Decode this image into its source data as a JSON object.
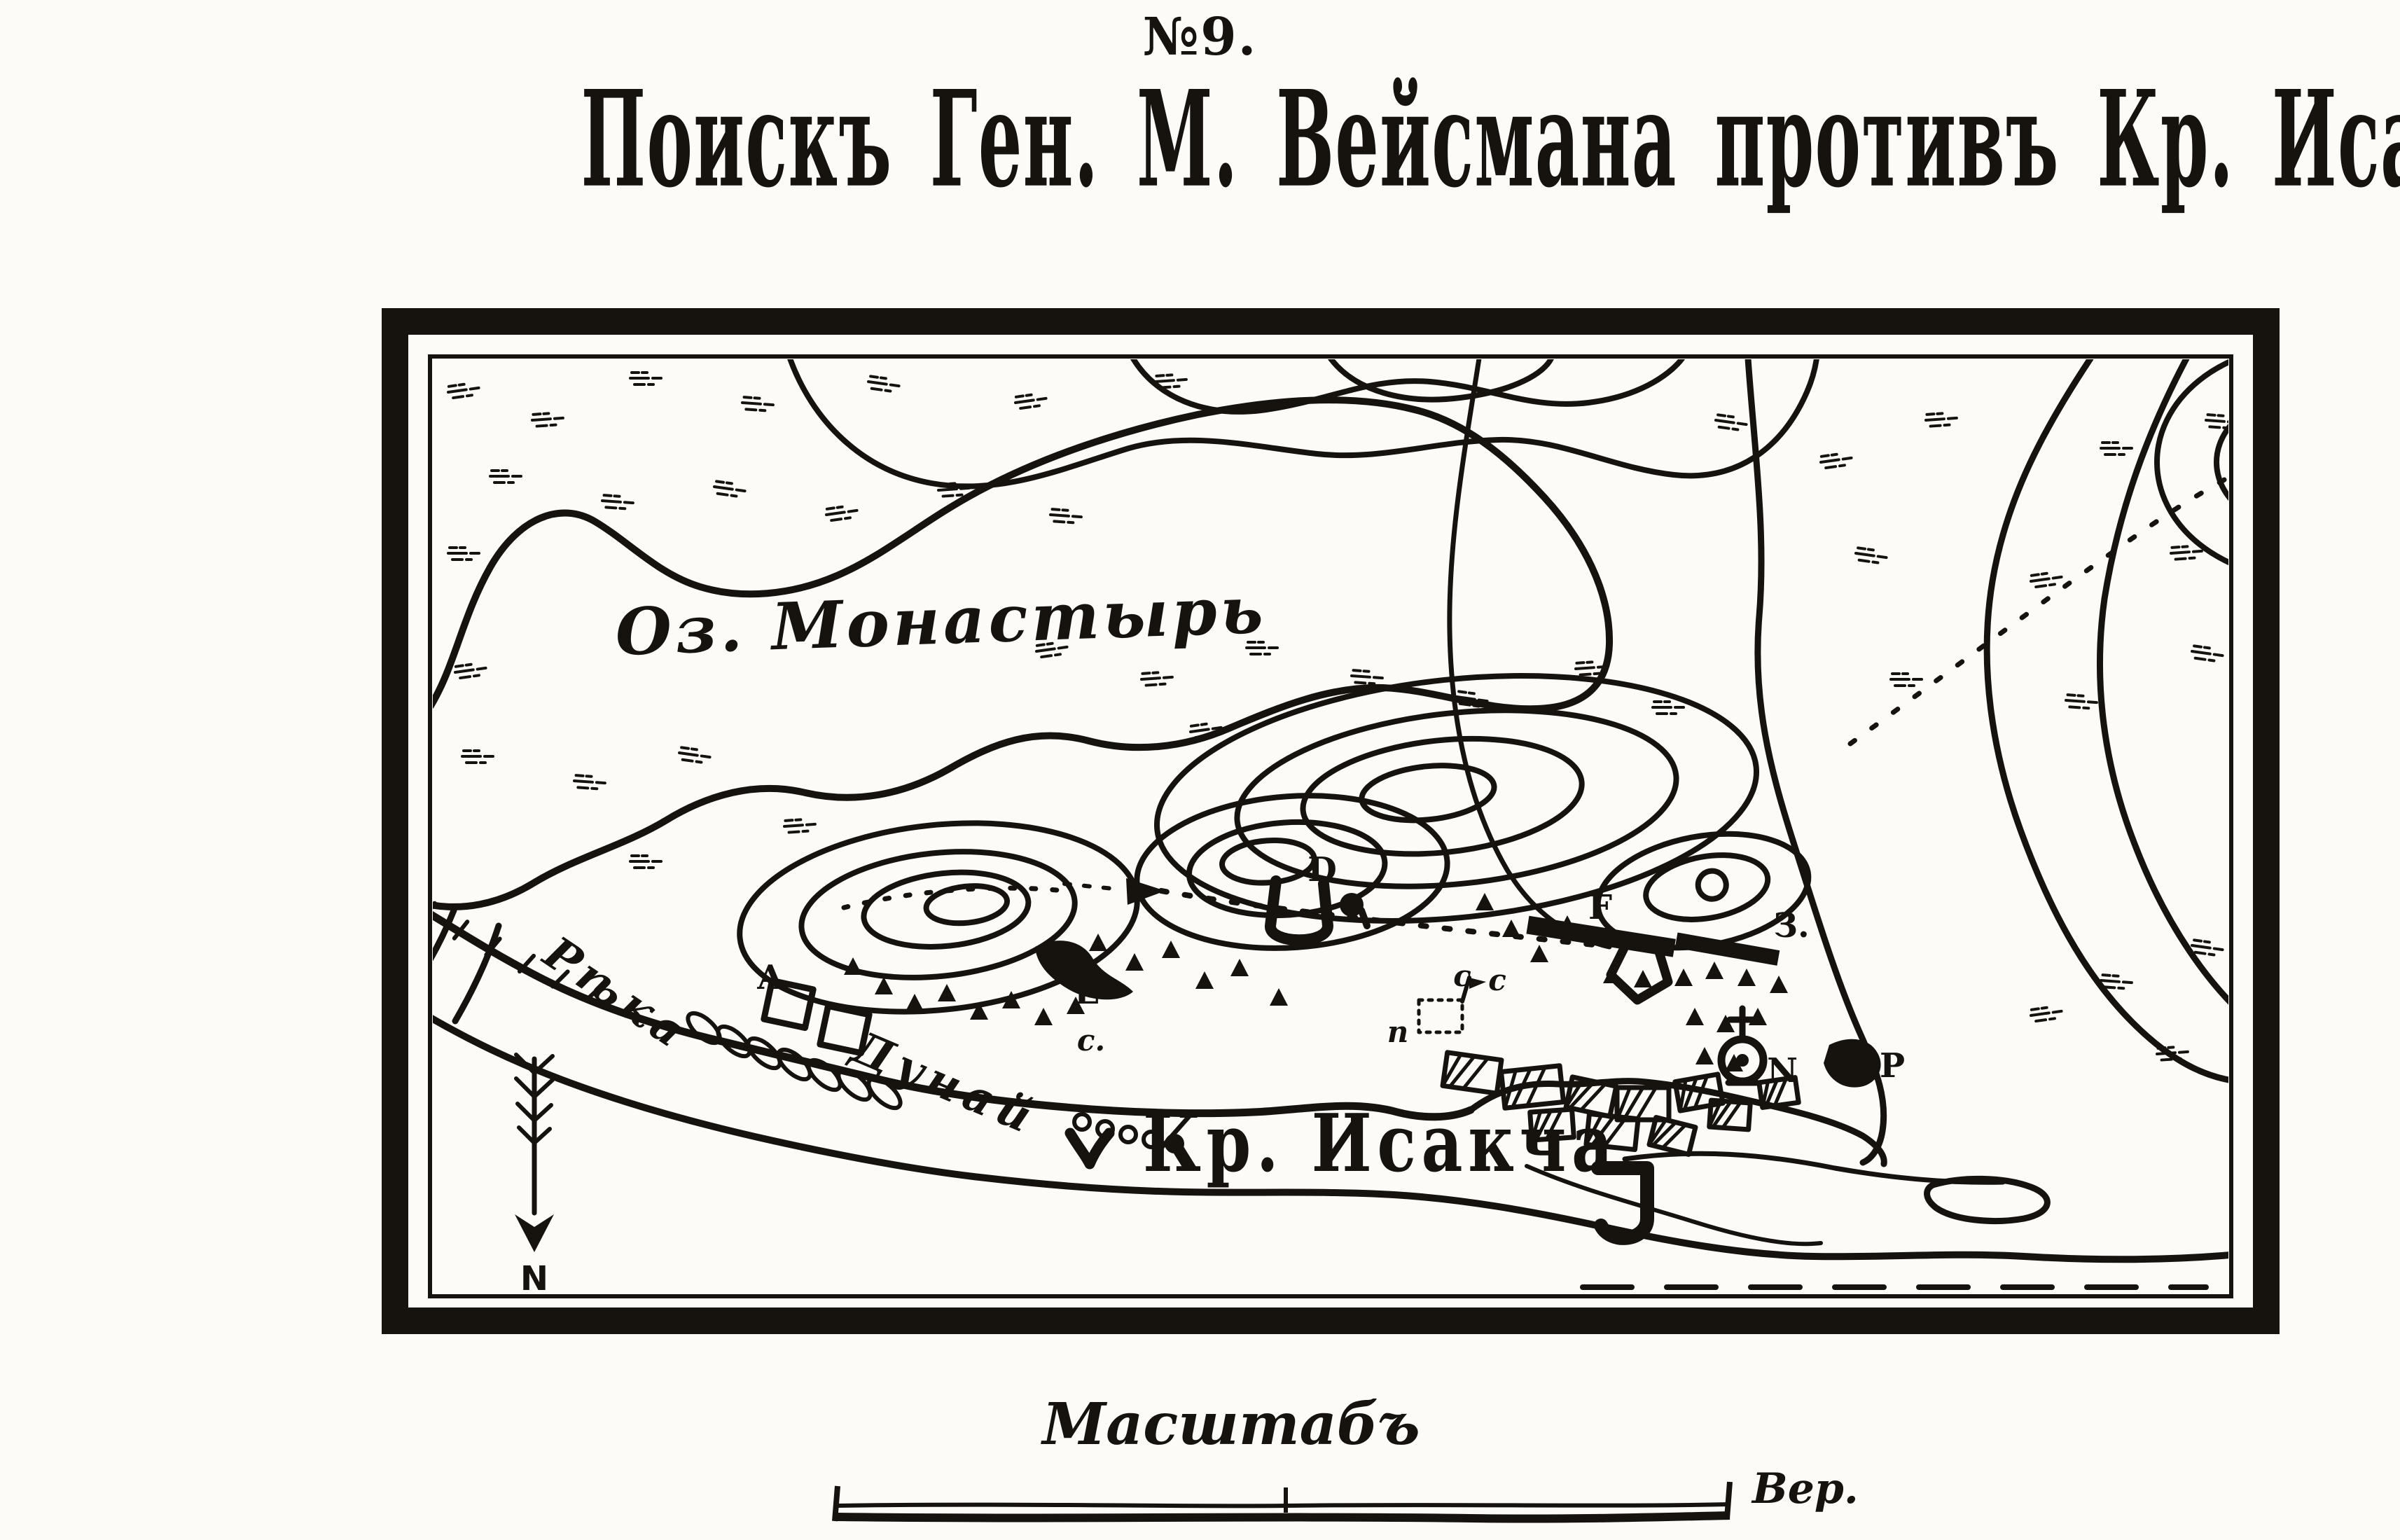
{
  "colors": {
    "ink": "#16130f",
    "paper": "#fcfbf8"
  },
  "header": {
    "figure_number": "№9.",
    "title": "Поискъ Ген. М. Вейсмана противъ Кр. Исакчи 16 Апрѣля 1771"
  },
  "map": {
    "labels": {
      "lake": "Оз. Монастырь",
      "river_word1": "Рѣка",
      "river_word2": "Дунай",
      "fortress": "Кр. Исакча",
      "north": "N"
    },
    "markers": [
      {
        "id": "battery-A",
        "label": "A"
      },
      {
        "id": "redoubt-D",
        "label": "D"
      },
      {
        "id": "post-E",
        "label": "E"
      },
      {
        "id": "post-E-sub",
        "label": "c."
      },
      {
        "id": "battery-F",
        "label": "F"
      },
      {
        "id": "battery-Z",
        "label": "З."
      },
      {
        "id": "point-N",
        "label": "N"
      },
      {
        "id": "point-P",
        "label": "P"
      },
      {
        "id": "picket-1",
        "label": "с"
      },
      {
        "id": "picket-2",
        "label": "с"
      },
      {
        "id": "picket-3",
        "label": "п"
      }
    ]
  },
  "scale": {
    "title": "Масштабъ",
    "unit": "Вер."
  }
}
